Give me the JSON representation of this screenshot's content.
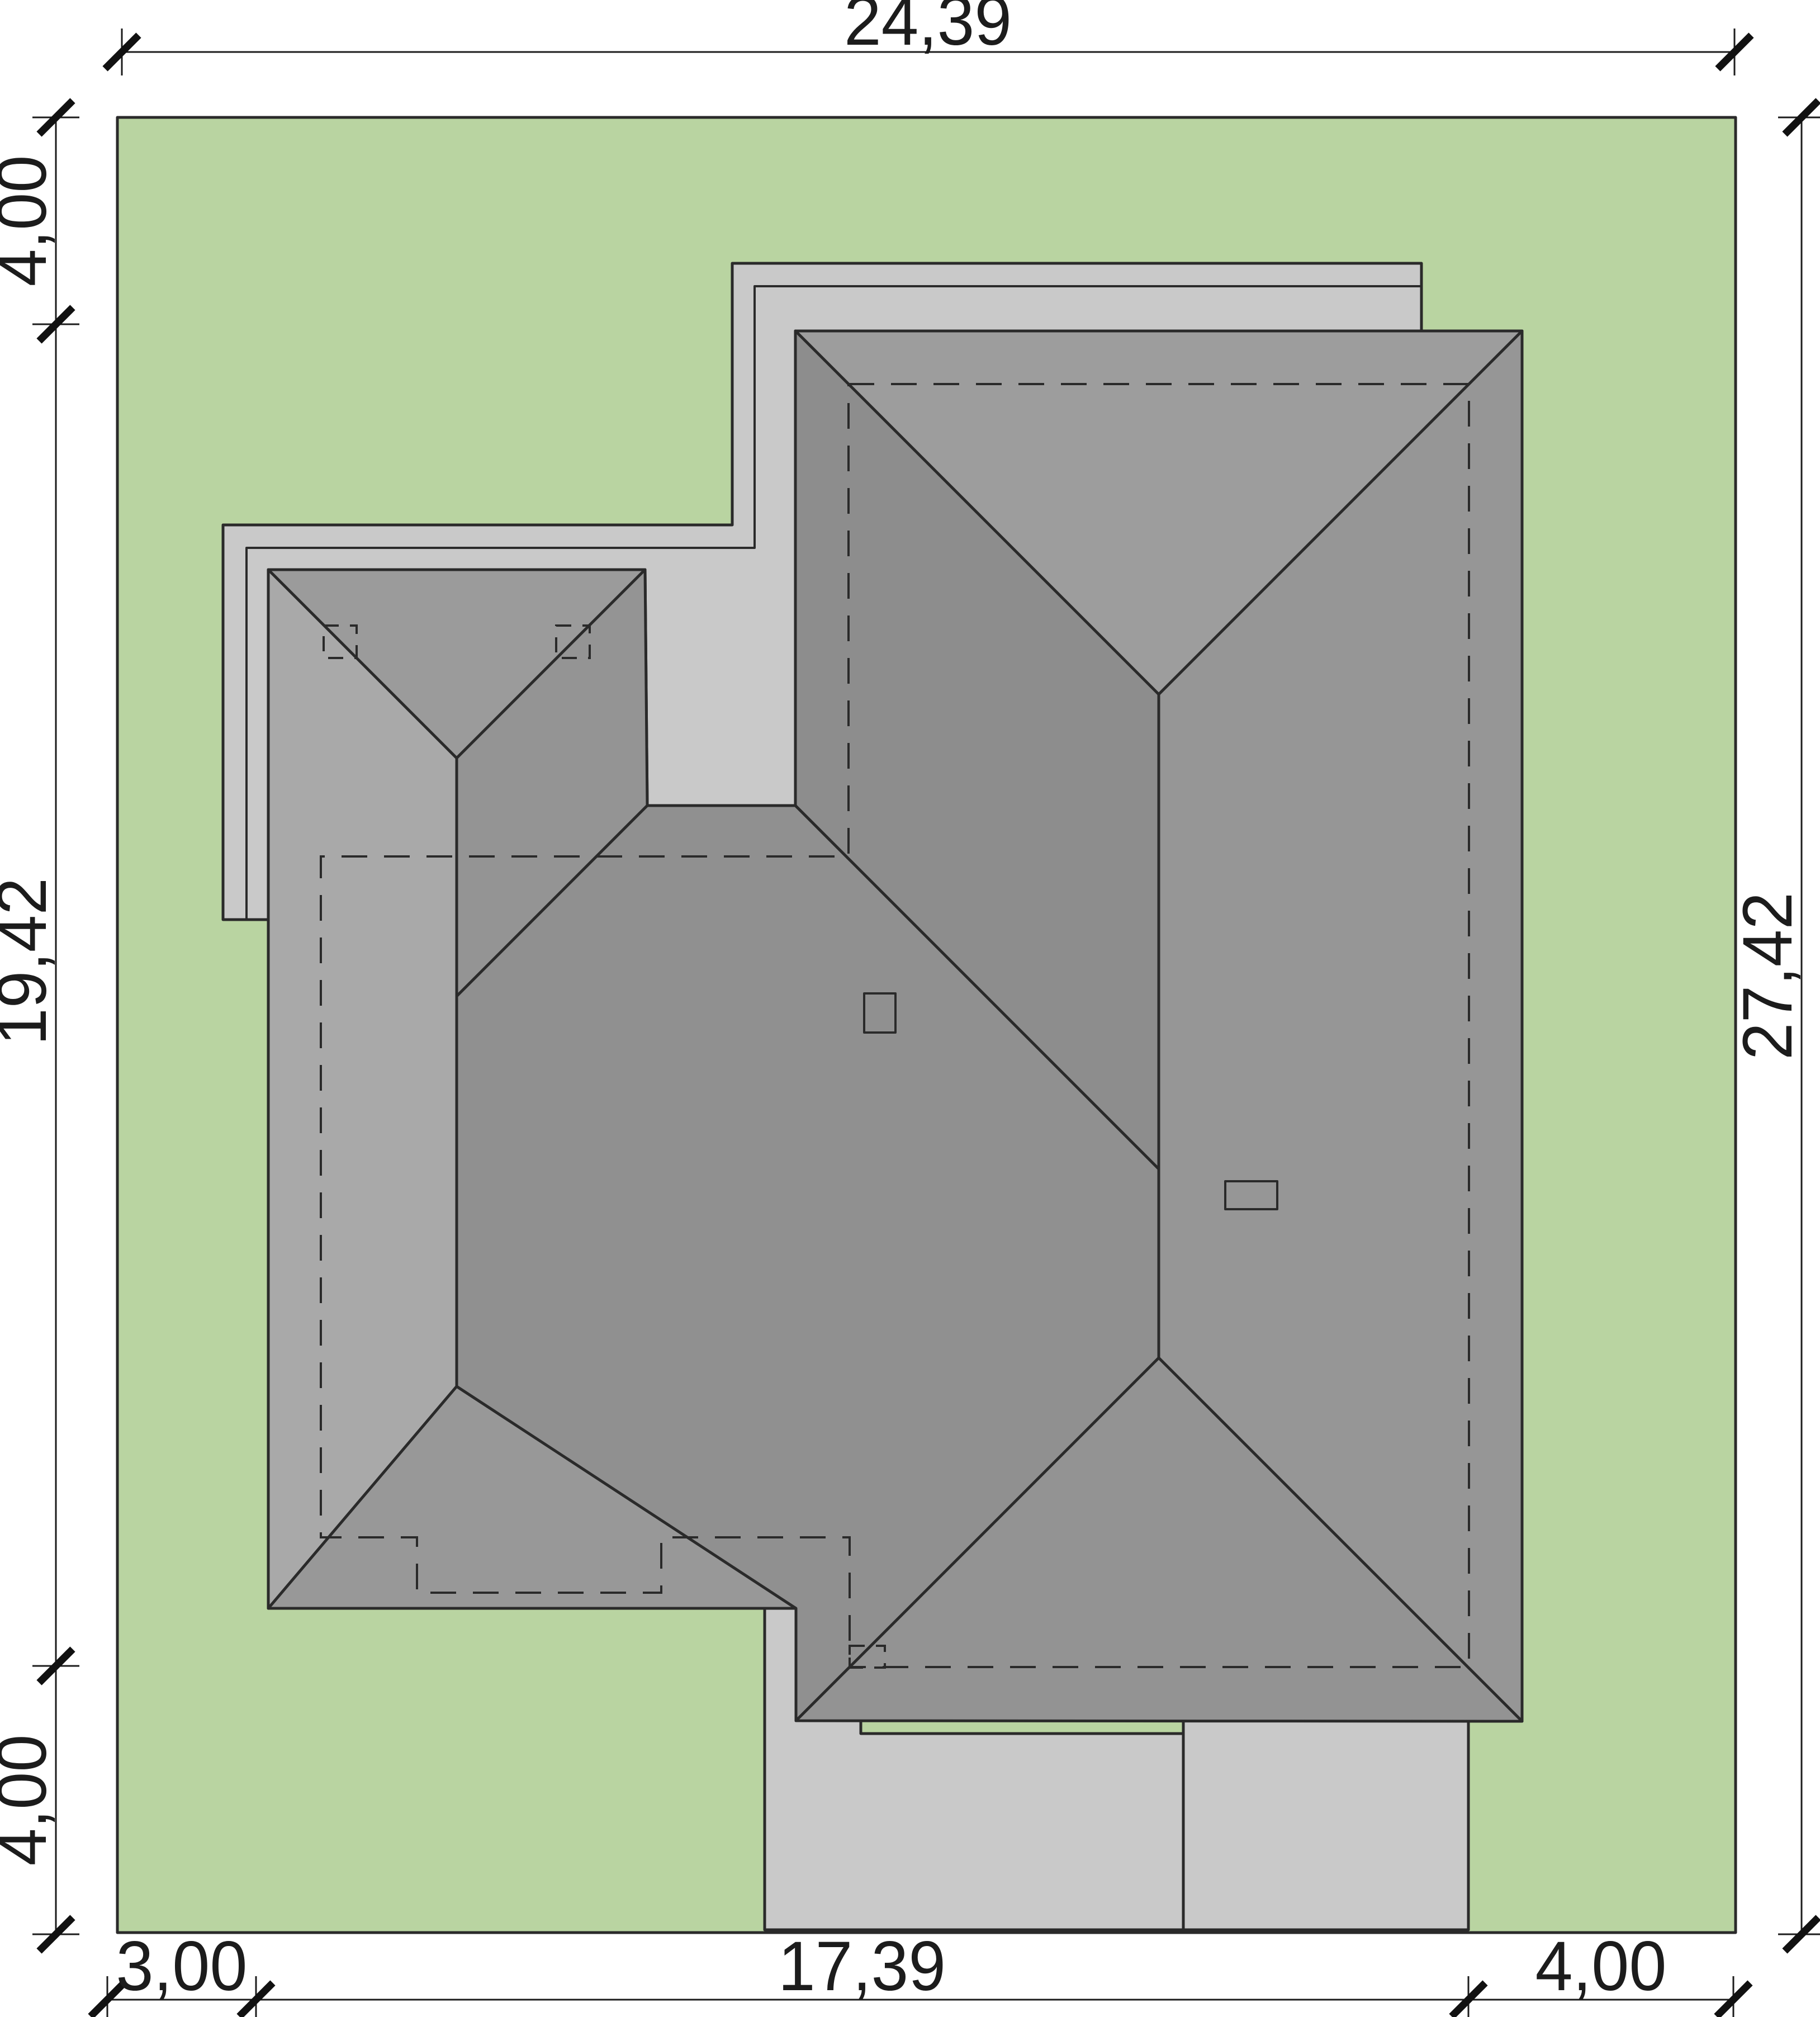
{
  "drawing": {
    "type": "house-site-plan-roof-view",
    "plot_label": "site plot",
    "dimensions": {
      "top": {
        "label": "24,39"
      },
      "right": {
        "label": "27,42"
      },
      "left": {
        "segments": [
          {
            "label": "4,00"
          },
          {
            "label": "19,42"
          },
          {
            "label": "4,00"
          }
        ]
      },
      "bottom": {
        "segments": [
          {
            "label": "3,00"
          },
          {
            "label": "17,39"
          },
          {
            "label": "4,00"
          }
        ]
      }
    },
    "colors": {
      "plot_green": "#b9d4a1",
      "paved": "#c9c9c9",
      "roof_garage_north": "#9b9b9b",
      "roof_garage_east": "#949494",
      "roof_left_west": "#a9a9a9",
      "roof_left_south": "#989898",
      "roof_middle": "#909090",
      "roof_main_north": "#9d9d9d",
      "roof_main_west": "#8d8d8d",
      "roof_main_east": "#969696",
      "roof_main_south": "#939393",
      "chimney": "#b2b2b2"
    }
  }
}
